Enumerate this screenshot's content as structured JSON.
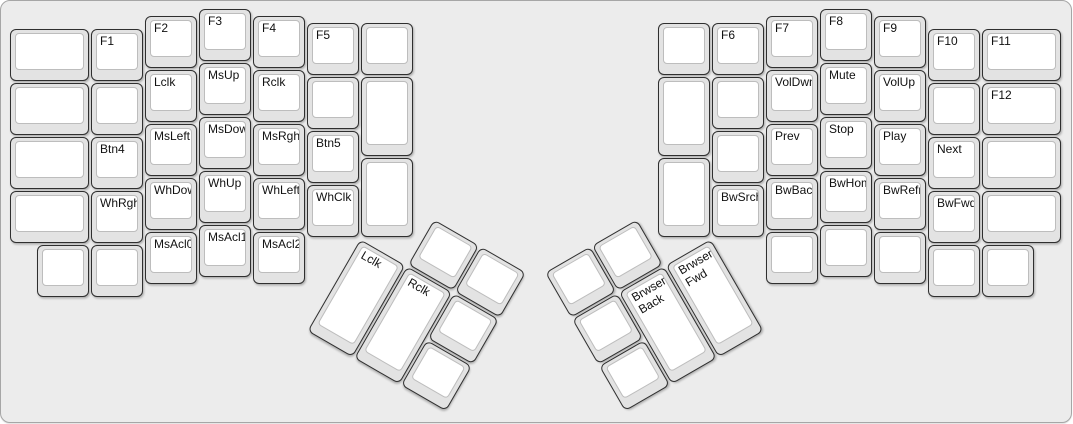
{
  "canvas": {
    "width": 1073,
    "height": 424,
    "page_background": "#ffffff"
  },
  "board": {
    "background": "#ececec",
    "border_color": "#a6a6a6",
    "corner_radius": 10
  },
  "keycap_style": {
    "base_fill": "#e3e3e3",
    "base_border": "#2f2f2f",
    "top_fill": "#ffffff",
    "top_border": "#bdbdbd",
    "label_color": "#111111"
  },
  "layout": {
    "unit_px": 54,
    "origin_x": 9,
    "origin_y": 8
  },
  "groups": [
    {
      "name": "left-main",
      "rotation": 0,
      "rx": 0,
      "ry": 0,
      "keys": [
        {
          "x": 0,
          "y": 0.375,
          "w": 1.5,
          "h": 1,
          "label": ""
        },
        {
          "x": 1.5,
          "y": 0.375,
          "w": 1,
          "h": 1,
          "label": "F1"
        },
        {
          "x": 2.5,
          "y": 0.125,
          "w": 1,
          "h": 1,
          "label": "F2"
        },
        {
          "x": 3.5,
          "y": 0,
          "w": 1,
          "h": 1,
          "label": "F3"
        },
        {
          "x": 4.5,
          "y": 0.125,
          "w": 1,
          "h": 1,
          "label": "F4"
        },
        {
          "x": 5.5,
          "y": 0.25,
          "w": 1,
          "h": 1,
          "label": "F5"
        },
        {
          "x": 6.5,
          "y": 0.25,
          "w": 1,
          "h": 1,
          "label": ""
        },
        {
          "x": 0,
          "y": 1.375,
          "w": 1.5,
          "h": 1,
          "label": ""
        },
        {
          "x": 1.5,
          "y": 1.375,
          "w": 1,
          "h": 1,
          "label": ""
        },
        {
          "x": 2.5,
          "y": 1.125,
          "w": 1,
          "h": 1,
          "label": "Lclk"
        },
        {
          "x": 3.5,
          "y": 1,
          "w": 1,
          "h": 1,
          "label": "MsUp"
        },
        {
          "x": 4.5,
          "y": 1.125,
          "w": 1,
          "h": 1,
          "label": "Rclk"
        },
        {
          "x": 5.5,
          "y": 1.25,
          "w": 1,
          "h": 1,
          "label": ""
        },
        {
          "x": 6.5,
          "y": 1.25,
          "w": 1,
          "h": 1.5,
          "label": ""
        },
        {
          "x": 0,
          "y": 2.375,
          "w": 1.5,
          "h": 1,
          "label": ""
        },
        {
          "x": 1.5,
          "y": 2.375,
          "w": 1,
          "h": 1,
          "label": "Btn4"
        },
        {
          "x": 2.5,
          "y": 2.125,
          "w": 1,
          "h": 1,
          "label": "MsLeft"
        },
        {
          "x": 3.5,
          "y": 2,
          "w": 1,
          "h": 1,
          "label": "MsDown"
        },
        {
          "x": 4.5,
          "y": 2.125,
          "w": 1,
          "h": 1,
          "label": "MsRght"
        },
        {
          "x": 5.5,
          "y": 2.25,
          "w": 1,
          "h": 1,
          "label": "Btn5"
        },
        {
          "x": 6.5,
          "y": 2.75,
          "w": 1,
          "h": 1.5,
          "label": ""
        },
        {
          "x": 0,
          "y": 3.375,
          "w": 1.5,
          "h": 1,
          "label": ""
        },
        {
          "x": 1.5,
          "y": 3.375,
          "w": 1,
          "h": 1,
          "label": "WhRght"
        },
        {
          "x": 2.5,
          "y": 3.125,
          "w": 1,
          "h": 1,
          "label": "WhDown"
        },
        {
          "x": 3.5,
          "y": 3,
          "w": 1,
          "h": 1,
          "label": "WhUp"
        },
        {
          "x": 4.5,
          "y": 3.125,
          "w": 1,
          "h": 1,
          "label": "WhLeft"
        },
        {
          "x": 5.5,
          "y": 3.25,
          "w": 1,
          "h": 1,
          "label": "WhClk"
        },
        {
          "x": 0.5,
          "y": 4.375,
          "w": 1,
          "h": 1,
          "label": ""
        },
        {
          "x": 1.5,
          "y": 4.375,
          "w": 1,
          "h": 1,
          "label": ""
        },
        {
          "x": 2.5,
          "y": 4.125,
          "w": 1,
          "h": 1,
          "label": "MsAcl0"
        },
        {
          "x": 3.5,
          "y": 4,
          "w": 1,
          "h": 1,
          "label": "MsAcl1"
        },
        {
          "x": 4.5,
          "y": 4.125,
          "w": 1,
          "h": 1,
          "label": "MsAcl2"
        }
      ]
    },
    {
      "name": "left-thumb",
      "rotation": 30,
      "rx": 6.5,
      "ry": 4.25,
      "keys": [
        {
          "x": 1,
          "y": -1,
          "w": 1,
          "h": 1,
          "label": ""
        },
        {
          "x": 2,
          "y": -1,
          "w": 1,
          "h": 1,
          "label": ""
        },
        {
          "x": 0,
          "y": 0,
          "w": 1,
          "h": 2,
          "label": "Lclk"
        },
        {
          "x": 1,
          "y": 0,
          "w": 1,
          "h": 2,
          "label": "Rclk"
        },
        {
          "x": 2,
          "y": 0,
          "w": 1,
          "h": 1,
          "label": ""
        },
        {
          "x": 2,
          "y": 1,
          "w": 1,
          "h": 1,
          "label": ""
        }
      ]
    },
    {
      "name": "right-main",
      "rotation": 0,
      "rx": 0,
      "ry": 0,
      "keys": [
        {
          "x": 12,
          "y": 0.25,
          "w": 1,
          "h": 1,
          "label": ""
        },
        {
          "x": 13,
          "y": 0.25,
          "w": 1,
          "h": 1,
          "label": "F6"
        },
        {
          "x": 14,
          "y": 0.125,
          "w": 1,
          "h": 1,
          "label": "F7"
        },
        {
          "x": 15,
          "y": 0,
          "w": 1,
          "h": 1,
          "label": "F8"
        },
        {
          "x": 16,
          "y": 0.125,
          "w": 1,
          "h": 1,
          "label": "F9"
        },
        {
          "x": 17,
          "y": 0.375,
          "w": 1,
          "h": 1,
          "label": "F10"
        },
        {
          "x": 18,
          "y": 0.375,
          "w": 1.5,
          "h": 1,
          "label": "F11"
        },
        {
          "x": 12,
          "y": 1.25,
          "w": 1,
          "h": 1.5,
          "label": ""
        },
        {
          "x": 13,
          "y": 1.25,
          "w": 1,
          "h": 1,
          "label": ""
        },
        {
          "x": 14,
          "y": 1.125,
          "w": 1,
          "h": 1,
          "label": "VolDwn"
        },
        {
          "x": 15,
          "y": 1,
          "w": 1,
          "h": 1,
          "label": "Mute"
        },
        {
          "x": 16,
          "y": 1.125,
          "w": 1,
          "h": 1,
          "label": "VolUp"
        },
        {
          "x": 17,
          "y": 1.375,
          "w": 1,
          "h": 1,
          "label": ""
        },
        {
          "x": 18,
          "y": 1.375,
          "w": 1.5,
          "h": 1,
          "label": "F12"
        },
        {
          "x": 12,
          "y": 2.75,
          "w": 1,
          "h": 1.5,
          "label": ""
        },
        {
          "x": 13,
          "y": 2.25,
          "w": 1,
          "h": 1,
          "label": ""
        },
        {
          "x": 14,
          "y": 2.125,
          "w": 1,
          "h": 1,
          "label": "Prev"
        },
        {
          "x": 15,
          "y": 2,
          "w": 1,
          "h": 1,
          "label": "Stop"
        },
        {
          "x": 16,
          "y": 2.125,
          "w": 1,
          "h": 1,
          "label": "Play"
        },
        {
          "x": 17,
          "y": 2.375,
          "w": 1,
          "h": 1,
          "label": "Next"
        },
        {
          "x": 18,
          "y": 2.375,
          "w": 1.5,
          "h": 1,
          "label": ""
        },
        {
          "x": 13,
          "y": 3.25,
          "w": 1,
          "h": 1,
          "label": "BwSrch"
        },
        {
          "x": 14,
          "y": 3.125,
          "w": 1,
          "h": 1,
          "label": "BwBack"
        },
        {
          "x": 15,
          "y": 3,
          "w": 1,
          "h": 1,
          "label": "BwHome"
        },
        {
          "x": 16,
          "y": 3.125,
          "w": 1,
          "h": 1,
          "label": "BwRefr"
        },
        {
          "x": 17,
          "y": 3.375,
          "w": 1,
          "h": 1,
          "label": "BwFwd"
        },
        {
          "x": 18,
          "y": 3.375,
          "w": 1.5,
          "h": 1,
          "label": ""
        },
        {
          "x": 14,
          "y": 4.125,
          "w": 1,
          "h": 1,
          "label": ""
        },
        {
          "x": 15,
          "y": 4,
          "w": 1,
          "h": 1,
          "label": ""
        },
        {
          "x": 16,
          "y": 4.125,
          "w": 1,
          "h": 1,
          "label": ""
        },
        {
          "x": 17,
          "y": 4.375,
          "w": 1,
          "h": 1,
          "label": ""
        },
        {
          "x": 18,
          "y": 4.375,
          "w": 1,
          "h": 1,
          "label": ""
        }
      ]
    },
    {
      "name": "right-thumb",
      "rotation": -30,
      "rx": 13,
      "ry": 4.25,
      "keys": [
        {
          "x": -3,
          "y": -1,
          "w": 1,
          "h": 1,
          "label": ""
        },
        {
          "x": -2,
          "y": -1,
          "w": 1,
          "h": 1,
          "label": ""
        },
        {
          "x": -3,
          "y": 0,
          "w": 1,
          "h": 1,
          "label": ""
        },
        {
          "x": -2,
          "y": 0,
          "w": 1,
          "h": 2,
          "label": "Brwser\nBack"
        },
        {
          "x": -1,
          "y": 0,
          "w": 1,
          "h": 2,
          "label": "Brwser\nFwd"
        },
        {
          "x": -3,
          "y": 1,
          "w": 1,
          "h": 1,
          "label": ""
        }
      ]
    }
  ]
}
